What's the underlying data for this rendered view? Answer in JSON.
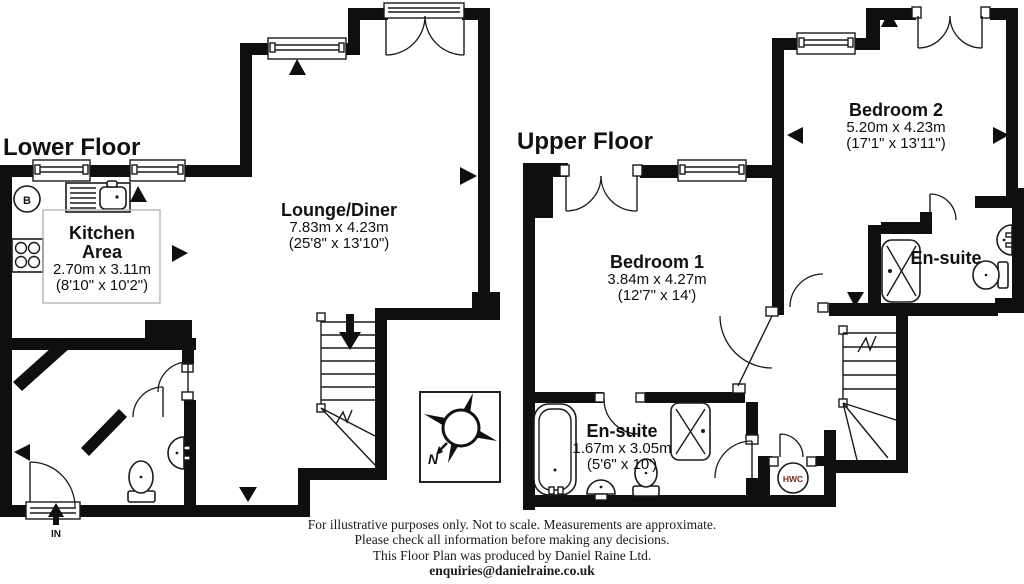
{
  "titles": {
    "lower": "Lower Floor",
    "upper": "Upper Floor"
  },
  "rooms": {
    "kitchen": {
      "name1": "Kitchen",
      "name2": "Area",
      "metric": "2.70m x 3.11m",
      "imperial": "(8'10\" x 10'2\")"
    },
    "lounge": {
      "name": "Lounge/Diner",
      "metric": "7.83m x 4.23m",
      "imperial": "(25'8\" x 13'10\")"
    },
    "bedroom1": {
      "name": "Bedroom 1",
      "metric": "3.84m x 4.27m",
      "imperial": "(12'7\" x 14')"
    },
    "bedroom2": {
      "name": "Bedroom 2",
      "metric": "5.20m x 4.23m",
      "imperial": "(17'1\" x 13'11\")"
    },
    "ensuite_upper": {
      "name": "En-suite"
    },
    "ensuite_lower": {
      "name": "En-suite",
      "metric": "1.67m x 3.05m",
      "imperial": "(5'6\" x 10')"
    }
  },
  "labels": {
    "boiler": "B",
    "hot_water_cylinder": "HWC",
    "entrance": "IN",
    "compass_north": "N"
  },
  "footer": {
    "line1": "For illustrative purposes only. Not to scale. Measurements are approximate.",
    "line2": "Please check all information before making any decisions.",
    "line3": "This Floor Plan was produced by Daniel Raine Ltd.",
    "email": "enquiries@danielraine.co.uk"
  },
  "colors": {
    "wall": "#0f0f0f",
    "hwc_text": "#7b2a22",
    "counter_outline": "#b5b5b5",
    "background": "#ffffff"
  }
}
